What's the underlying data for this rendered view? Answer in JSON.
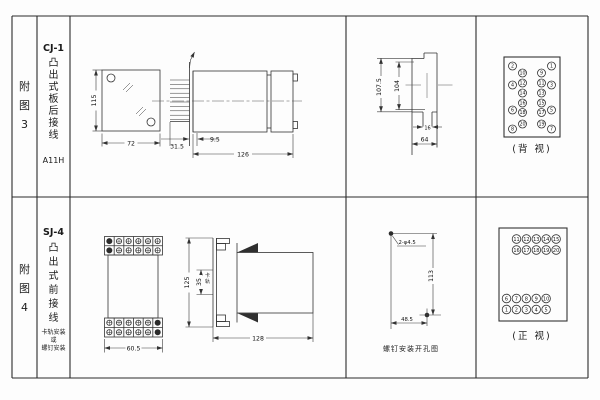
{
  "page": {
    "background": "#fdfdfd",
    "line_color": "#333333",
    "text_color": "#1a1a1a"
  },
  "row1": {
    "fig_label": "附图3",
    "model": "CJ-1",
    "type_label": "凸出式板后接线",
    "code": "A11H",
    "front_view": {
      "height_dim": "115",
      "width_dim": "72"
    },
    "side_view": {
      "panel_offset_dim": "31.5",
      "depth_small_dim": "9.5",
      "length_dim": "126"
    },
    "cutout": {
      "outer_height_dim": "107.5",
      "inner_height_dim": "104",
      "tab_width_dim": "16",
      "width_dim": "64"
    },
    "back_view": {
      "caption": "(背 视)",
      "terminals": {
        "outer_left": [
          "2",
          "4",
          "6",
          "8"
        ],
        "inner_left": [
          "10",
          "12",
          "14",
          "16",
          "18",
          "20"
        ],
        "inner_right": [
          "9",
          "11",
          "13",
          "15",
          "17",
          "19"
        ],
        "outer_right": [
          "1",
          "3",
          "5",
          "7"
        ]
      }
    }
  },
  "row2": {
    "fig_label": "附图4",
    "model": "SJ-4",
    "type_label": "凸出式前接线",
    "mount_note": [
      "卡轨安装",
      "或",
      "螺钉安装"
    ],
    "front_view": {
      "width_dim": "60.5"
    },
    "side_view": {
      "height_dim": "125",
      "rail_dim": "35",
      "rail_label": "卡轨",
      "length_dim": "128"
    },
    "drill": {
      "caption": "螺钉安装开孔图",
      "hole_label": "2-φ4.5",
      "vertical_dim": "113",
      "horizontal_dim": "48.5"
    },
    "front_terminal_view": {
      "caption": "(正 视)",
      "terminals": {
        "top_rows": [
          [
            "11",
            "12",
            "13",
            "14",
            "15"
          ],
          [
            "16",
            "17",
            "18",
            "19",
            "20"
          ]
        ],
        "bottom_rows": [
          [
            "6",
            "7",
            "8",
            "9",
            "10"
          ],
          [
            "1",
            "2",
            "3",
            "4",
            "5"
          ]
        ]
      }
    }
  }
}
